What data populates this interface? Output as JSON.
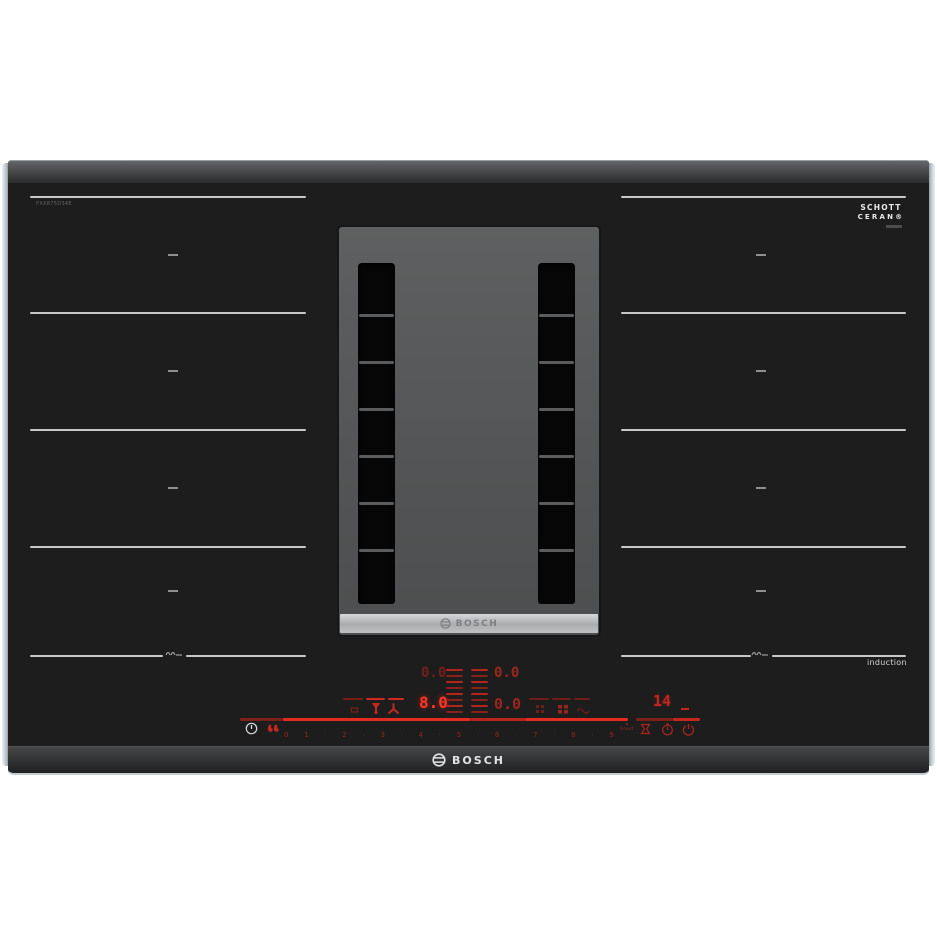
{
  "product": {
    "model_label": "PXX875D34E",
    "glass_brand_line1": "SCHOTT",
    "glass_brand_line2": "CERAN®",
    "induction_label": "induction"
  },
  "vent_module": {
    "logo_text": "BOSCH"
  },
  "front_edge": {
    "logo_text": "BOSCH"
  },
  "displays": {
    "back_left_power": "0.0",
    "front_left_power": "8.0",
    "back_right_power": "0.0",
    "front_right_power": "0.0",
    "timer_value": "14"
  },
  "controls": {
    "power_levels": [
      "0",
      "1",
      "2",
      "3",
      "4",
      "5",
      "6",
      "7",
      "8",
      "9"
    ],
    "boost_label": "boost",
    "icons": {
      "main_power": "power-circle-icon",
      "child_lock_flames": "double-flame-icon",
      "vent_auto": "pot-icon",
      "vent_hood": "hood-icon",
      "vent_fan": "fan-icon",
      "zone_select_left": "grid-icon",
      "zone_select_right": "grid-icon",
      "wiper": "wipe-protection-icon",
      "short_timer": "hourglass-icon",
      "timer": "clock-icon",
      "zone_power": "power-icon",
      "flex_pan": "pan-icon"
    }
  },
  "colors": {
    "glass": "#1d1d1e",
    "zone_line": "#c7c7c7",
    "display_bright": "#ff3526",
    "display_mid": "#9c261d",
    "display_dim": "#74201a",
    "accent_red": "#e52b1f"
  }
}
